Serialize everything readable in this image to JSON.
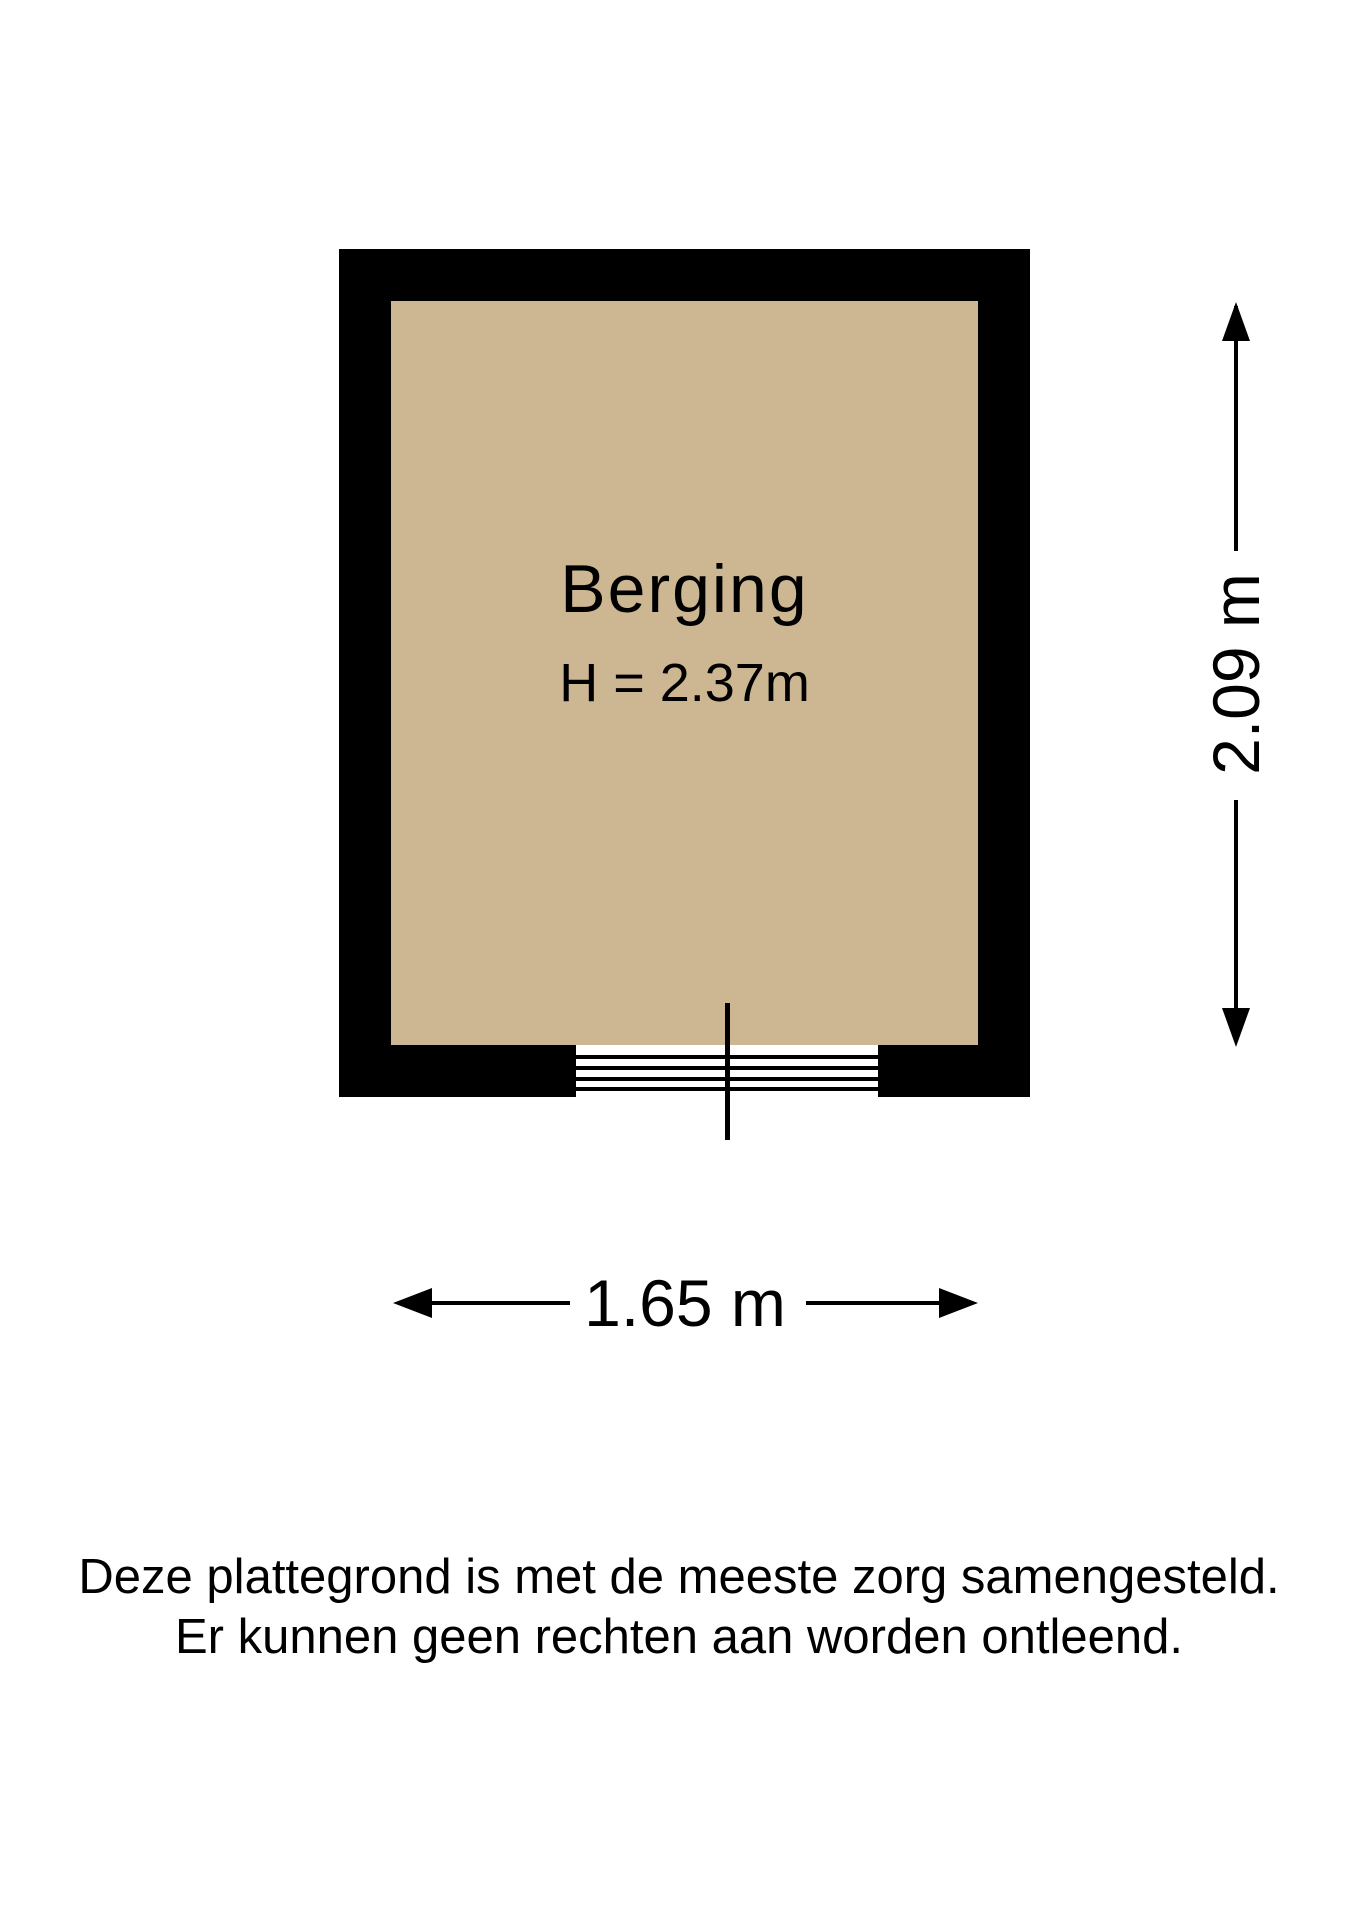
{
  "floorplan": {
    "room": {
      "name": "Berging",
      "ceiling_height_label": "H = 2.37m",
      "floor_color": "#cdb692",
      "wall_color": "#000000"
    },
    "dimensions": {
      "width_label": "1.65 m",
      "height_label": "2.09 m"
    },
    "disclaimer": {
      "line1": "Deze plattegrond is met de meeste zorg samengesteld.",
      "line2": "Er kunnen geen rechten aan worden ontleend."
    }
  }
}
